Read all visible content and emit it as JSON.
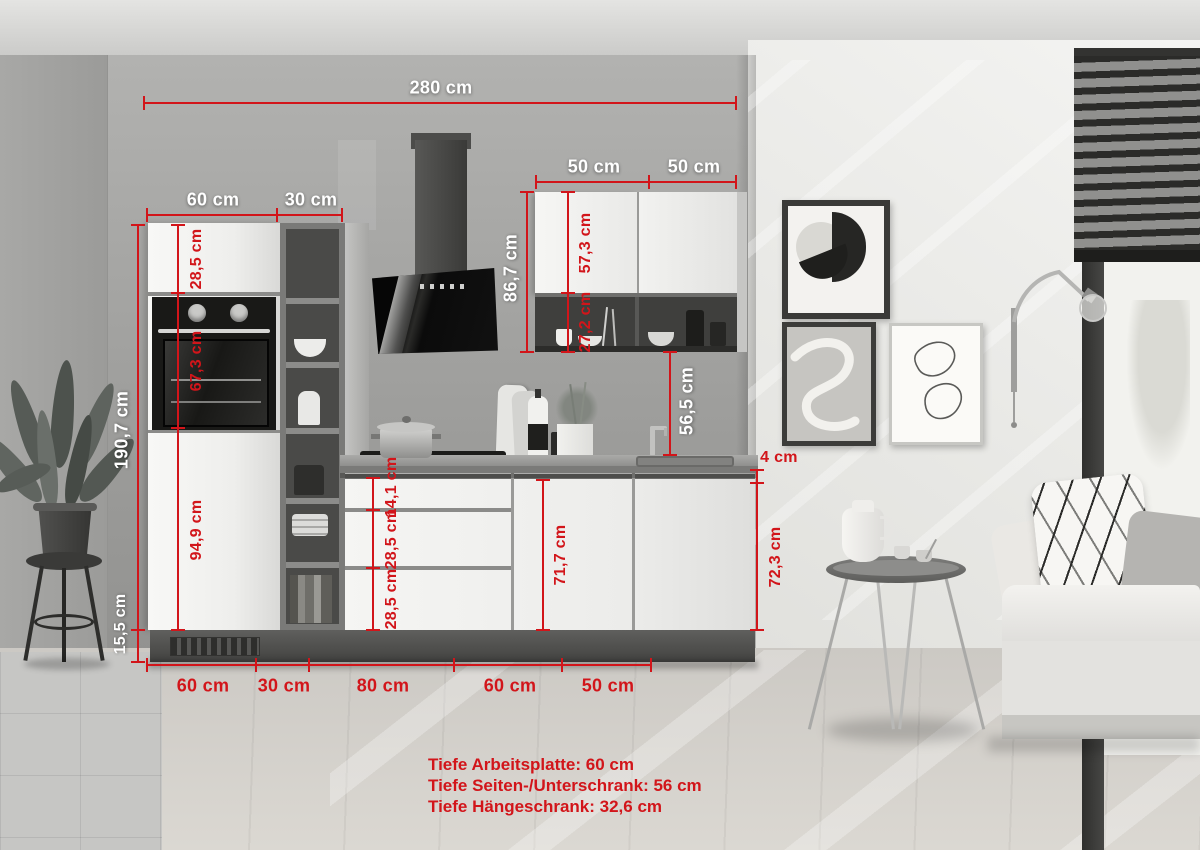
{
  "dims": {
    "total_width": "280 cm",
    "upper_left": "50 cm",
    "upper_right": "50 cm",
    "tall_width": "60 cm",
    "shelf_width": "30 cm",
    "tall_height": "190,7 cm",
    "tall_top": "28,5 cm",
    "oven": "67,3 cm",
    "tall_bottom": "94,9 cm",
    "plinth": "15,5 cm",
    "hood_span": "86,7 cm",
    "upper_door": "57,3 cm",
    "open_shelf": "27,2 cm",
    "backsplash": "56,5 cm",
    "worktop": "4 cm",
    "base_total": "72,3 cm",
    "drawer_top": "14,1 cm",
    "drawer_mid": "28,5 cm",
    "drawer_bottom": "28,5 cm",
    "base_door": "71,7 cm",
    "floor_60a": "60 cm",
    "floor_30": "30 cm",
    "floor_80": "80 cm",
    "floor_60b": "60 cm",
    "floor_50": "50 cm"
  },
  "notes": {
    "line1": "Tiefe Arbeitsplatte: 60 cm",
    "line2": "Tiefe Seiten-/Unterschrank: 56 cm",
    "line3": "Tiefe Hängeschrank: 32,6 cm"
  },
  "colors": {
    "accent": "#d2151a",
    "label_light": "#ffffff"
  }
}
